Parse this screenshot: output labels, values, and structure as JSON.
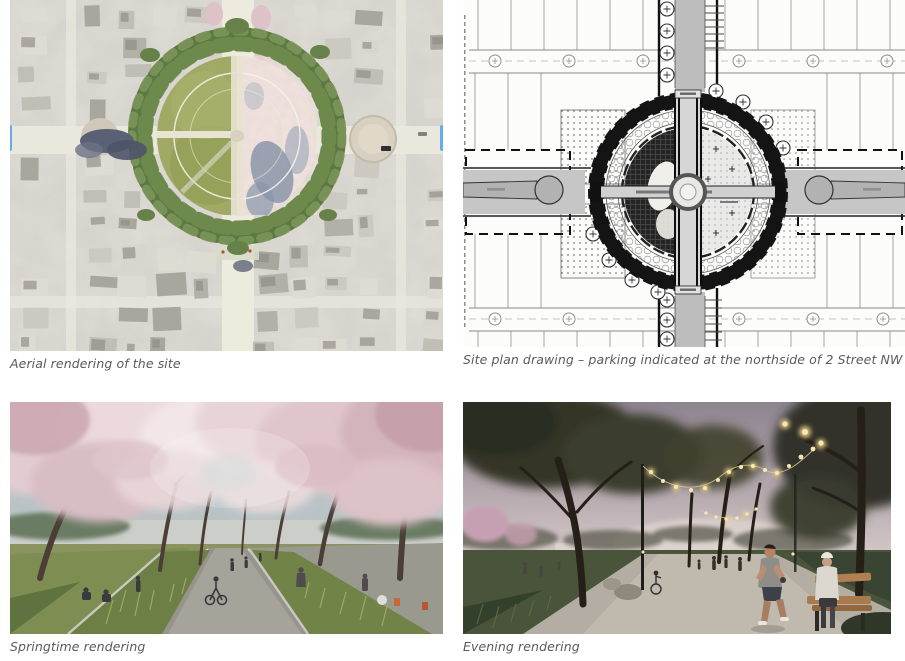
{
  "figures": [
    {
      "id": "aerial",
      "caption": "Aerial rendering of the site"
    },
    {
      "id": "site-plan",
      "caption": "Site plan drawing – parking indicated at the northside of 2 Street NW"
    },
    {
      "id": "spring",
      "caption": "Springtime rendering"
    },
    {
      "id": "evening",
      "caption": "Evening rendering"
    }
  ],
  "colors": {
    "caption_text": "#595a5e",
    "selection_accent": "#63aeea",
    "page_background": "#ffffff"
  }
}
